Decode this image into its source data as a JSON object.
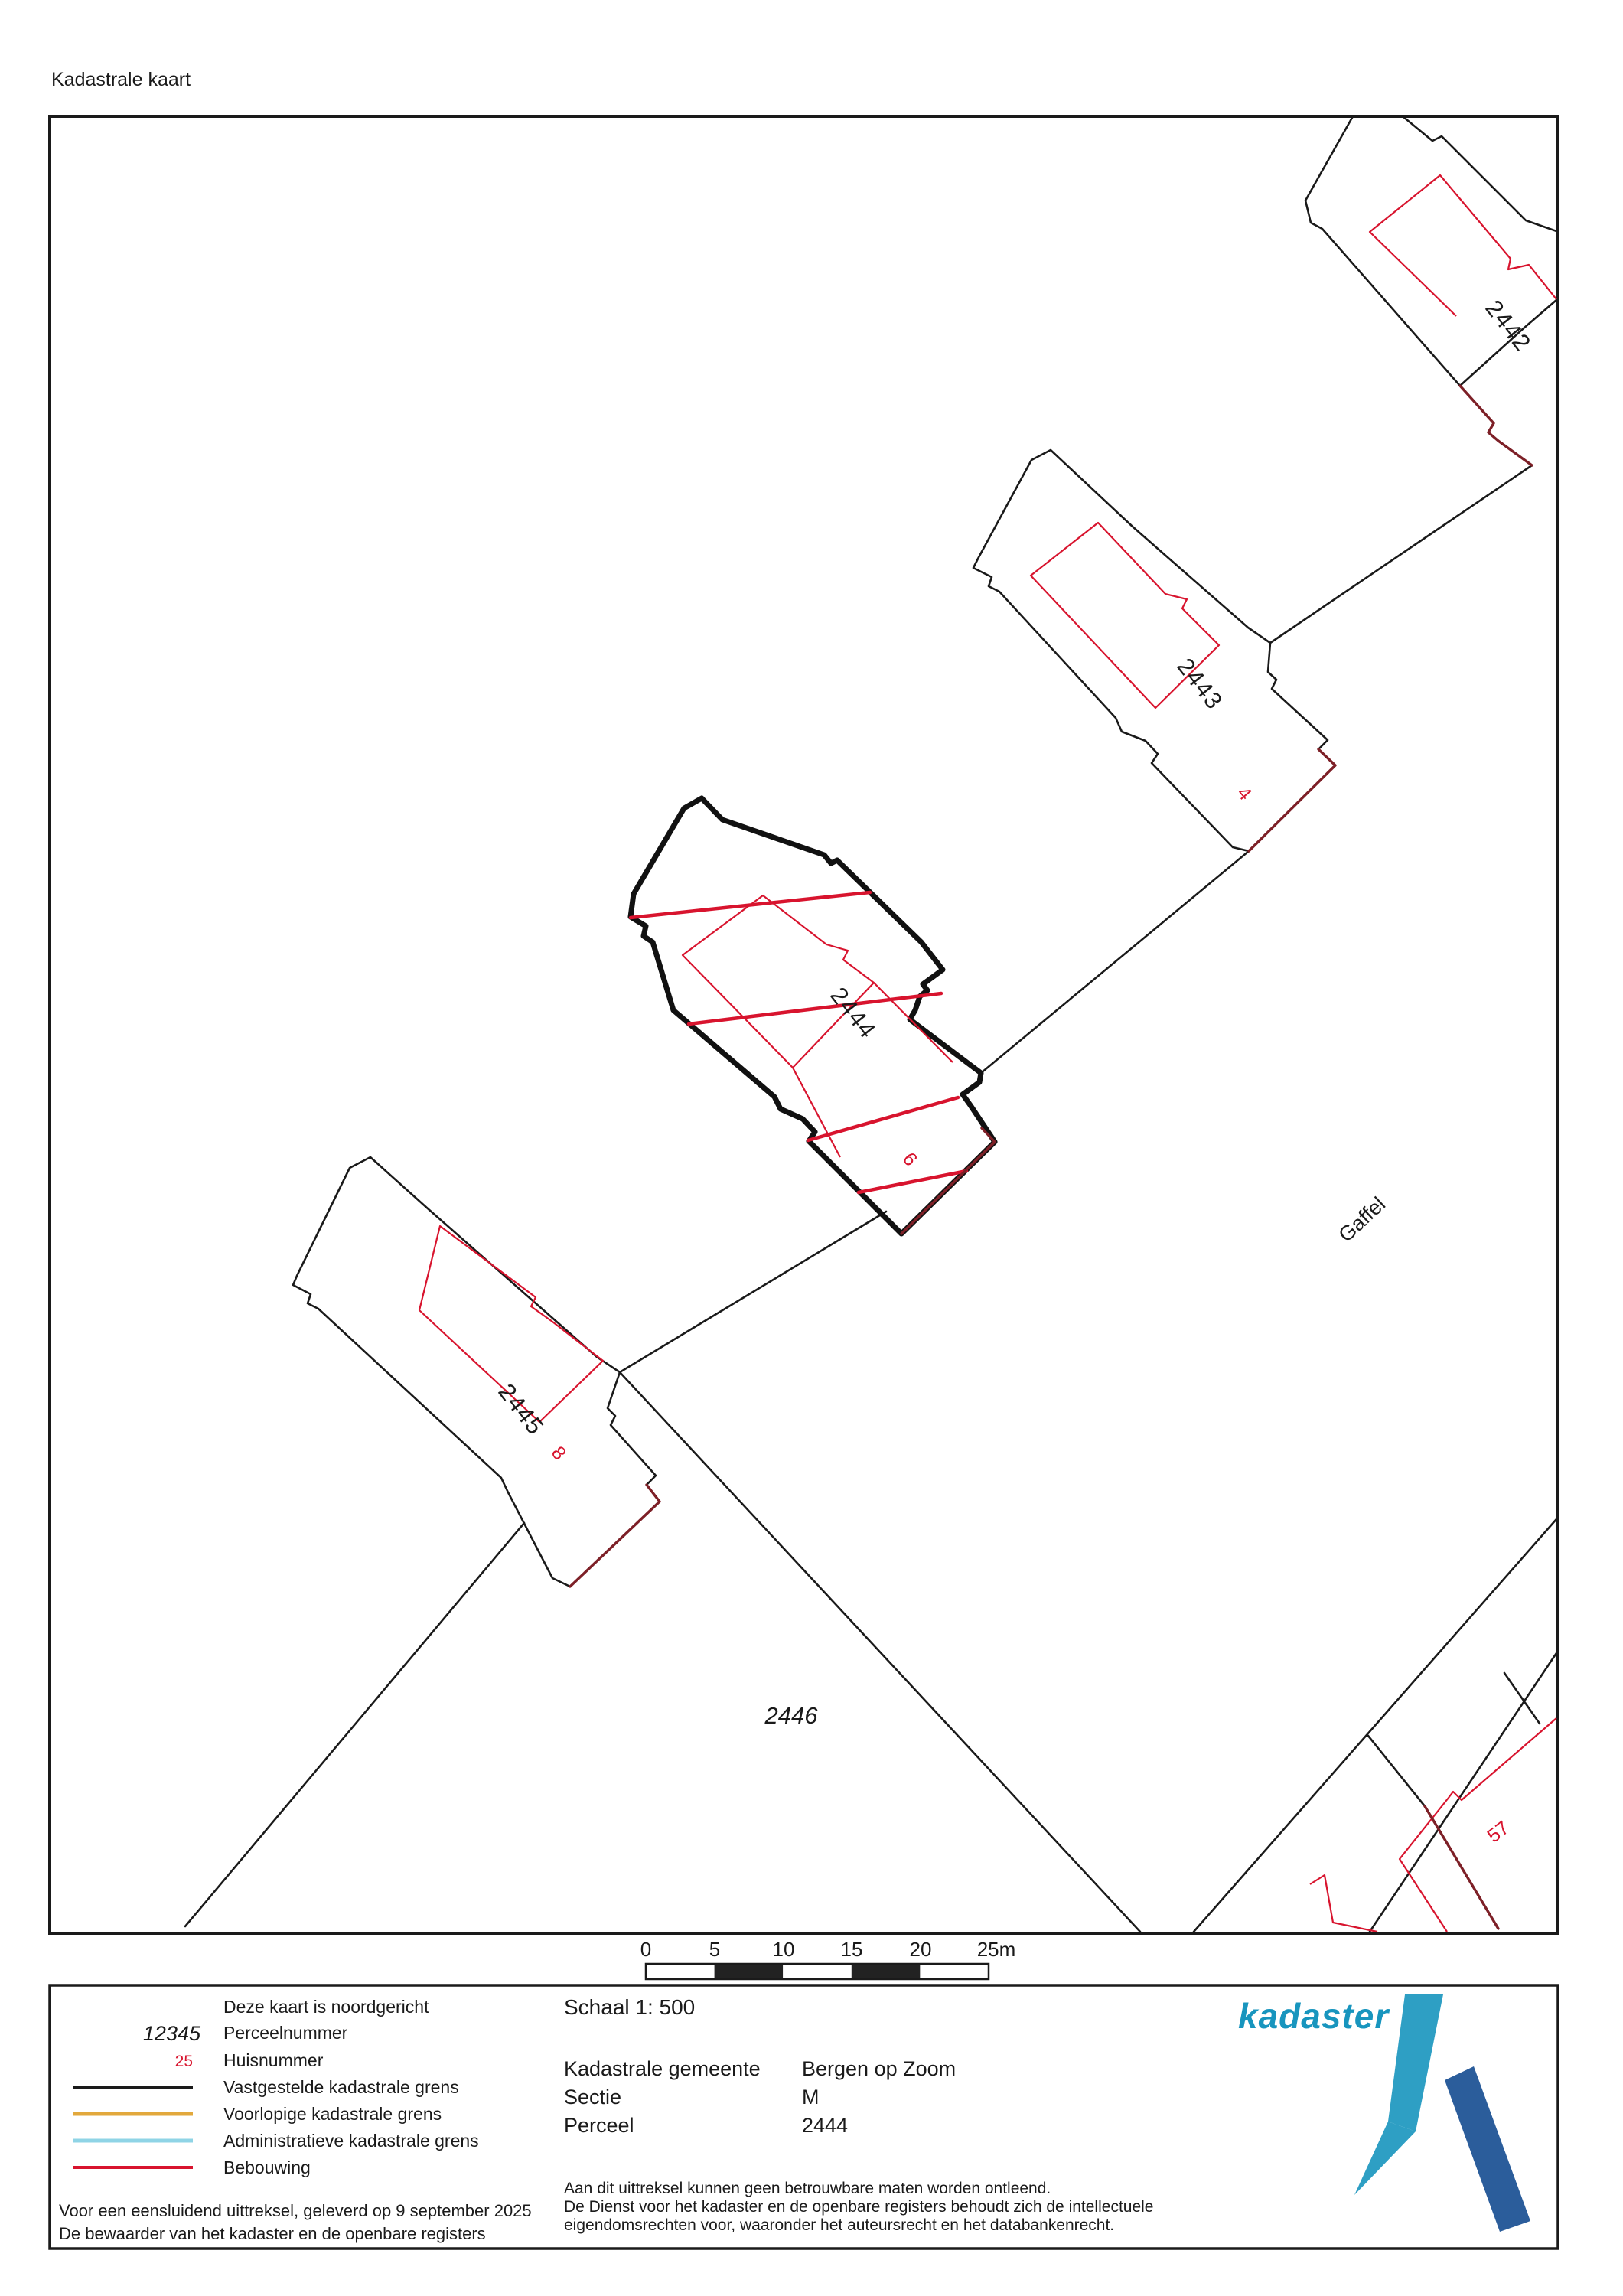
{
  "title": "Kadastrale kaart",
  "map": {
    "parcel_labels": [
      "2442",
      "2443",
      "2444",
      "2445",
      "2446"
    ],
    "house_numbers": [
      "4",
      "6",
      "8",
      "57"
    ],
    "street_name": "Gaffel",
    "subject_parcel": "2444"
  },
  "scalebar": {
    "ticks": [
      "0",
      "5",
      "10",
      "15",
      "20",
      "25m"
    ]
  },
  "legend": {
    "north_note": "Deze kaart is noordgericht",
    "perceel_symbol": "12345",
    "perceel_label": "Perceelnummer",
    "huisnummer_symbol": "25",
    "huisnummer_label": "Huisnummer",
    "line_items": [
      "Vastgestelde kadastrale grens",
      "Voorlopige kadastrale grens",
      "Administratieve kadastrale grens",
      "Bebouwing"
    ],
    "delivery_line1": "Voor een eensluidend uittreksel, geleverd op 9 september 2025",
    "delivery_line2": "De bewaarder van het kadaster en de openbare registers"
  },
  "details": {
    "scale": "Schaal 1: 500",
    "fields": [
      {
        "label": "Kadastrale gemeente",
        "value": "Bergen op Zoom"
      },
      {
        "label": "Sectie",
        "value": "M"
      },
      {
        "label": "Perceel",
        "value": "2444"
      }
    ],
    "disclaimer": [
      "Aan dit uittreksel kunnen geen betrouwbare maten worden ontleend.",
      "De Dienst voor het kadaster en de openbare registers behoudt zich de intellectuele",
      "eigendomsrechten voor, waaronder het auteursrecht en het databankenrecht."
    ]
  },
  "logo": {
    "text": "kadaster"
  },
  "colors": {
    "boundary": "#1a1a1a",
    "building": "#d8142e",
    "building_overlap": "#7d2027",
    "provisional": "#e2a83c",
    "administrative": "#8fd4e6",
    "logo_teal": "#1895BE",
    "logo_blue": "#2B5D9B"
  }
}
